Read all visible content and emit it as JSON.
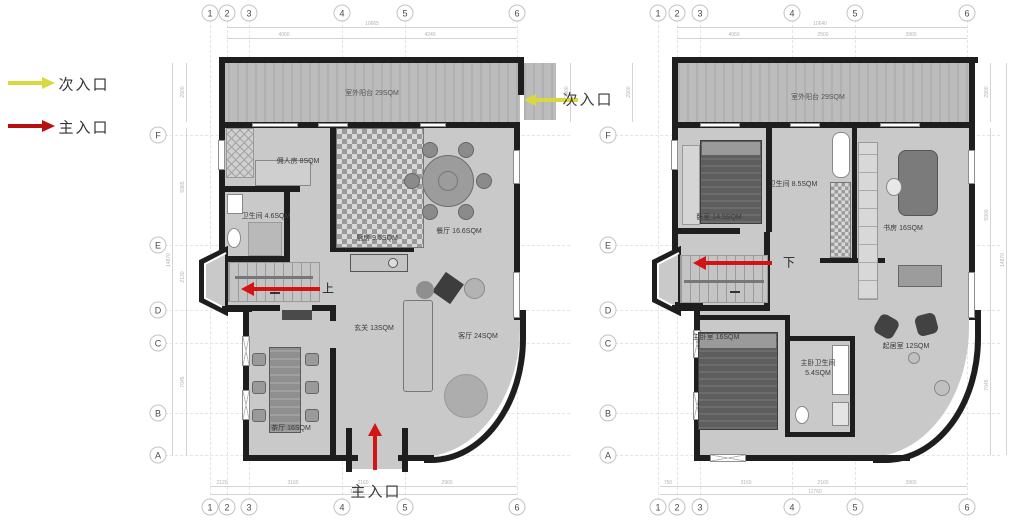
{
  "legend": {
    "secondary": {
      "label": "次入口",
      "color": "#d9d93f"
    },
    "main": {
      "label": "主入口",
      "color": "#b90f0f"
    }
  },
  "floor1": {
    "grid_cols": [
      "1",
      "2",
      "3",
      "4",
      "5",
      "6"
    ],
    "grid_rows": [
      "F",
      "E",
      "D",
      "C",
      "B",
      "A"
    ],
    "terrace_label": "室外阳台 29SQM",
    "rooms": {
      "maid": "佣人房 8SQM",
      "bath": "卫生间 4.6SQM",
      "kitchen": "厨房 9.5SQM",
      "dining": "餐厅 16.6SQM",
      "foyer": "玄关 13SQM",
      "living": "客厅 24SQM",
      "tea": "茶厅 16SQM"
    },
    "stair_label": "上",
    "main_entry_label": "主入口",
    "secondary_entry_label": "次入口",
    "dims": {
      "top_total": "10665",
      "top_segs": [
        "4060",
        "4240"
      ],
      "bottom_segs": [
        "2120",
        "3160",
        "2160",
        "2960"
      ],
      "bottom_total": "10650",
      "left_segs": [
        "2900",
        "5985",
        "2130",
        "7045"
      ],
      "left_total": "14870",
      "right_segs": [
        "2900"
      ]
    }
  },
  "floor2": {
    "grid_cols": [
      "1",
      "2",
      "3",
      "4",
      "5",
      "6"
    ],
    "grid_rows": [
      "F",
      "E",
      "D",
      "C",
      "B",
      "A"
    ],
    "terrace_label": "室外阳台 29SQM",
    "rooms": {
      "bedroom": "卧室 14.5SQM",
      "bath": "卫生间 8.5SQM",
      "study": "书房 16SQM",
      "master": "主卧室 16SQM",
      "master_bath": "主卧卫生间 5.4SQM",
      "sitting": "起居室 12SQM"
    },
    "stair_label": "下",
    "dims": {
      "top_total": "10640",
      "top_segs": [
        "4060",
        "2500",
        "3960"
      ],
      "bottom_segs": [
        "750",
        "3160",
        "2160",
        "3960"
      ],
      "bottom_total": "11760",
      "left_segs": [
        "2900"
      ],
      "right_segs": [
        "2900",
        "5900",
        "7045"
      ],
      "right_total": "14870"
    }
  }
}
